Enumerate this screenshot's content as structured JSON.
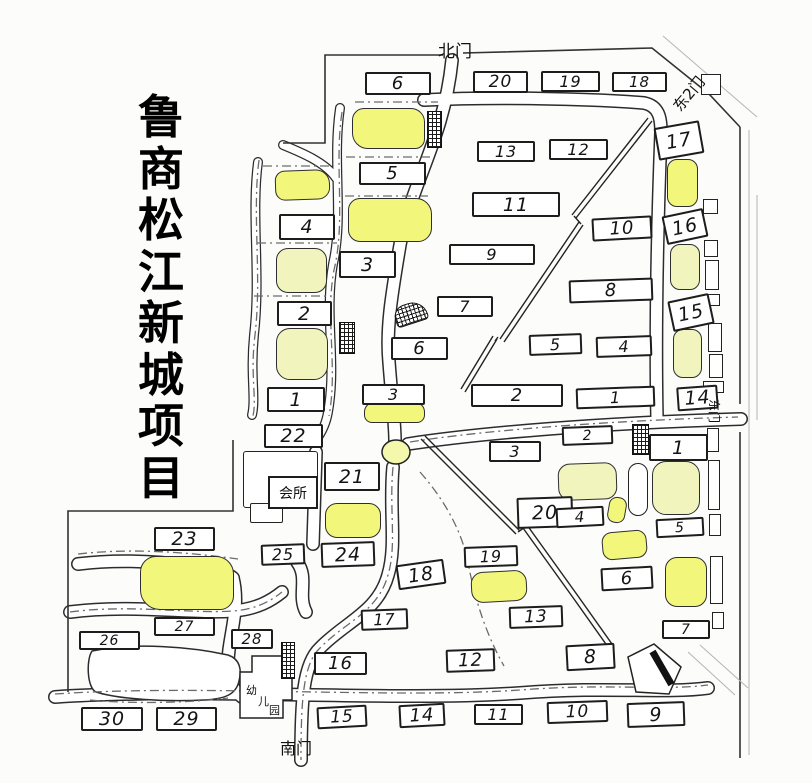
{
  "title": {
    "text": "鲁商松江新城项目",
    "vertical_text": "鲁\n商\n松\n江\n新\n城\n项\n目"
  },
  "colors": {
    "ink": "#222222",
    "highlight_yellow": "#f2f77b",
    "pale_yellow": "#f1f5bd",
    "paper": "#fcfcfa"
  },
  "gates": [
    {
      "id": "north-gate-label",
      "label": "北门",
      "x": 438,
      "y": 37,
      "rot": 0,
      "size": 17
    },
    {
      "id": "northeast-gate-label",
      "label": "东2门",
      "x": 668,
      "y": 102,
      "rot": -50,
      "size": 15
    },
    {
      "id": "east-gate-label",
      "label": "东门",
      "x": 723,
      "y": 399,
      "rot": 90,
      "size": 12
    },
    {
      "id": "south-gate-label",
      "label": "南门",
      "x": 280,
      "y": 735,
      "rot": 0,
      "size": 16
    }
  ],
  "special_buildings": {
    "clubhouse": {
      "label": "会所"
    },
    "kindergarten": {
      "label": "幼儿园",
      "chars": [
        "幼",
        "儿",
        "园"
      ]
    }
  },
  "roundabout": {
    "cx": 396,
    "cy": 452,
    "rx": 14,
    "ry": 12
  },
  "numbered_boxes": [
    {
      "label": "6",
      "x": 365,
      "y": 72,
      "w": 66,
      "h": 23,
      "rot": 0
    },
    {
      "label": "5",
      "x": 359,
      "y": 162,
      "w": 67,
      "h": 23,
      "rot": 0
    },
    {
      "label": "4",
      "x": 279,
      "y": 214,
      "w": 56,
      "h": 26,
      "rot": 0
    },
    {
      "label": "3",
      "x": 339,
      "y": 251,
      "w": 57,
      "h": 27,
      "rot": 0
    },
    {
      "label": "2",
      "x": 277,
      "y": 301,
      "w": 55,
      "h": 25,
      "rot": 0
    },
    {
      "label": "1",
      "x": 267,
      "y": 387,
      "w": 58,
      "h": 25,
      "rot": 0
    },
    {
      "label": "20",
      "x": 473,
      "y": 71,
      "w": 55,
      "h": 22,
      "rot": 0
    },
    {
      "label": "19",
      "x": 541,
      "y": 71,
      "w": 59,
      "h": 21,
      "rot": 0
    },
    {
      "label": "18",
      "x": 612,
      "y": 72,
      "w": 55,
      "h": 20,
      "rot": 0
    },
    {
      "label": "13",
      "x": 477,
      "y": 141,
      "w": 58,
      "h": 21,
      "rot": 0
    },
    {
      "label": "12",
      "x": 549,
      "y": 139,
      "w": 59,
      "h": 21,
      "rot": 0
    },
    {
      "label": "11",
      "x": 472,
      "y": 192,
      "w": 88,
      "h": 25,
      "rot": 0
    },
    {
      "label": "10",
      "x": 592,
      "y": 217,
      "w": 60,
      "h": 23,
      "rot": -3
    },
    {
      "label": "9",
      "x": 449,
      "y": 244,
      "w": 86,
      "h": 21,
      "rot": 0
    },
    {
      "label": "8",
      "x": 569,
      "y": 279,
      "w": 84,
      "h": 23,
      "rot": -2
    },
    {
      "label": "7",
      "x": 437,
      "y": 296,
      "w": 56,
      "h": 21,
      "rot": 0
    },
    {
      "label": "6",
      "x": 391,
      "y": 337,
      "w": 57,
      "h": 23,
      "rot": 0
    },
    {
      "label": "5",
      "x": 529,
      "y": 334,
      "w": 53,
      "h": 21,
      "rot": -2
    },
    {
      "label": "4",
      "x": 596,
      "y": 336,
      "w": 56,
      "h": 21,
      "rot": -2
    },
    {
      "label": "3",
      "x": 362,
      "y": 384,
      "w": 63,
      "h": 21,
      "rot": 0
    },
    {
      "label": "2",
      "x": 471,
      "y": 384,
      "w": 92,
      "h": 23,
      "rot": 0
    },
    {
      "label": "1",
      "x": 576,
      "y": 387,
      "w": 79,
      "h": 21,
      "rot": -2
    },
    {
      "label": "17",
      "x": 656,
      "y": 124,
      "w": 46,
      "h": 33,
      "rot": -10
    },
    {
      "label": "16",
      "x": 664,
      "y": 212,
      "w": 42,
      "h": 29,
      "rot": -12
    },
    {
      "label": "15",
      "x": 670,
      "y": 297,
      "w": 42,
      "h": 31,
      "rot": -12
    },
    {
      "label": "14",
      "x": 677,
      "y": 386,
      "w": 41,
      "h": 24,
      "rot": -4
    },
    {
      "label": "22",
      "x": 264,
      "y": 424,
      "w": 59,
      "h": 24,
      "rot": 0
    },
    {
      "label": "21",
      "x": 324,
      "y": 462,
      "w": 56,
      "h": 29,
      "rot": 0
    },
    {
      "label": "2",
      "x": 562,
      "y": 426,
      "w": 51,
      "h": 19,
      "rot": -2
    },
    {
      "label": "1",
      "x": 649,
      "y": 434,
      "w": 59,
      "h": 27,
      "rot": 0
    },
    {
      "label": "3",
      "x": 489,
      "y": 441,
      "w": 52,
      "h": 21,
      "rot": 0
    },
    {
      "label": "20",
      "x": 517,
      "y": 497,
      "w": 56,
      "h": 31,
      "rot": -2
    },
    {
      "label": "4",
      "x": 556,
      "y": 507,
      "w": 48,
      "h": 20,
      "rot": -3
    },
    {
      "label": "5",
      "x": 656,
      "y": 518,
      "w": 48,
      "h": 19,
      "rot": -3
    },
    {
      "label": "6",
      "x": 601,
      "y": 567,
      "w": 52,
      "h": 23,
      "rot": -3
    },
    {
      "label": "7",
      "x": 662,
      "y": 620,
      "w": 48,
      "h": 19,
      "rot": 0
    },
    {
      "label": "19",
      "x": 464,
      "y": 546,
      "w": 54,
      "h": 21,
      "rot": -2
    },
    {
      "label": "18",
      "x": 397,
      "y": 562,
      "w": 48,
      "h": 25,
      "rot": -8
    },
    {
      "label": "13",
      "x": 509,
      "y": 606,
      "w": 54,
      "h": 22,
      "rot": -2
    },
    {
      "label": "17",
      "x": 361,
      "y": 609,
      "w": 47,
      "h": 21,
      "rot": -2
    },
    {
      "label": "16",
      "x": 314,
      "y": 652,
      "w": 53,
      "h": 23,
      "rot": 0
    },
    {
      "label": "12",
      "x": 446,
      "y": 649,
      "w": 49,
      "h": 23,
      "rot": -2
    },
    {
      "label": "8",
      "x": 566,
      "y": 644,
      "w": 49,
      "h": 26,
      "rot": -3
    },
    {
      "label": "15",
      "x": 317,
      "y": 706,
      "w": 50,
      "h": 22,
      "rot": -3
    },
    {
      "label": "14",
      "x": 399,
      "y": 704,
      "w": 46,
      "h": 23,
      "rot": -3
    },
    {
      "label": "11",
      "x": 474,
      "y": 704,
      "w": 49,
      "h": 21,
      "rot": 0
    },
    {
      "label": "10",
      "x": 547,
      "y": 701,
      "w": 61,
      "h": 22,
      "rot": -2
    },
    {
      "label": "9",
      "x": 627,
      "y": 702,
      "w": 58,
      "h": 25,
      "rot": -2
    },
    {
      "label": "23",
      "x": 154,
      "y": 527,
      "w": 61,
      "h": 24,
      "rot": 0
    },
    {
      "label": "25",
      "x": 261,
      "y": 544,
      "w": 44,
      "h": 21,
      "rot": -2
    },
    {
      "label": "24",
      "x": 321,
      "y": 542,
      "w": 54,
      "h": 25,
      "rot": -2
    },
    {
      "label": "26",
      "x": 79,
      "y": 631,
      "w": 61,
      "h": 19,
      "rot": 0
    },
    {
      "label": "27",
      "x": 154,
      "y": 617,
      "w": 61,
      "h": 19,
      "rot": 0
    },
    {
      "label": "28",
      "x": 231,
      "y": 629,
      "w": 42,
      "h": 20,
      "rot": 0
    },
    {
      "label": "30",
      "x": 81,
      "y": 707,
      "w": 62,
      "h": 24,
      "rot": 0
    },
    {
      "label": "29",
      "x": 156,
      "y": 707,
      "w": 61,
      "h": 24,
      "rot": 0
    }
  ],
  "yellow_buildings": [
    {
      "x": 352,
      "y": 108,
      "w": 73,
      "h": 41,
      "shade": "bright",
      "r": "12px 14px 10px 16px",
      "rot": 0
    },
    {
      "x": 275,
      "y": 170,
      "w": 55,
      "h": 30,
      "shade": "bright",
      "r": "10px 14px 12px 10px",
      "rot": -2
    },
    {
      "x": 348,
      "y": 198,
      "w": 84,
      "h": 44,
      "shade": "bright",
      "r": "12px 16px 14px 12px",
      "rot": 0
    },
    {
      "x": 276,
      "y": 248,
      "w": 51,
      "h": 45,
      "shade": "pale",
      "r": "12px",
      "rot": 0
    },
    {
      "x": 276,
      "y": 328,
      "w": 52,
      "h": 52,
      "shade": "pale",
      "r": "14px",
      "rot": 0
    },
    {
      "x": 667,
      "y": 159,
      "w": 31,
      "h": 48,
      "shade": "bright",
      "r": "10px",
      "rot": 0
    },
    {
      "x": 670,
      "y": 244,
      "w": 30,
      "h": 46,
      "shade": "pale",
      "r": "10px",
      "rot": 0
    },
    {
      "x": 673,
      "y": 329,
      "w": 29,
      "h": 49,
      "shade": "pale",
      "r": "10px",
      "rot": 0
    },
    {
      "x": 325,
      "y": 503,
      "w": 56,
      "h": 35,
      "shade": "bright",
      "r": "12px",
      "rot": 0
    },
    {
      "x": 558,
      "y": 463,
      "w": 59,
      "h": 37,
      "shade": "pale",
      "r": "12px",
      "rot": -2
    },
    {
      "x": 652,
      "y": 461,
      "w": 48,
      "h": 54,
      "shade": "pale",
      "r": "14px",
      "rot": 0
    },
    {
      "x": 608,
      "y": 497,
      "w": 18,
      "h": 26,
      "shade": "bright",
      "r": "8px",
      "rot": 10
    },
    {
      "x": 602,
      "y": 531,
      "w": 45,
      "h": 28,
      "shade": "bright",
      "r": "10px",
      "rot": -5
    },
    {
      "x": 665,
      "y": 557,
      "w": 42,
      "h": 50,
      "shade": "bright",
      "r": "12px",
      "rot": 0
    },
    {
      "x": 471,
      "y": 571,
      "w": 56,
      "h": 31,
      "shade": "bright",
      "r": "12px",
      "rot": -3
    },
    {
      "x": 140,
      "y": 556,
      "w": 94,
      "h": 54,
      "shade": "bright",
      "r": "16px 18px 14px 20px",
      "rot": 0
    },
    {
      "x": 364,
      "y": 402,
      "w": 61,
      "h": 21,
      "shade": "bright",
      "r": "10px 10px 8px 8px",
      "rot": 0
    }
  ],
  "white_buildings": [
    {
      "x": 628,
      "y": 463,
      "w": 20,
      "h": 53,
      "r": "10px",
      "rot": 0
    },
    {
      "x": 243,
      "y": 451,
      "w": 75,
      "h": 57,
      "r": "3px",
      "rot": 0
    },
    {
      "x": 250,
      "y": 503,
      "w": 33,
      "h": 20,
      "r": "2px",
      "rot": 0
    }
  ],
  "small_units": [
    {
      "x": 701,
      "y": 74,
      "w": 20,
      "h": 21
    },
    {
      "x": 703,
      "y": 199,
      "w": 15,
      "h": 15
    },
    {
      "x": 704,
      "y": 240,
      "w": 14,
      "h": 17
    },
    {
      "x": 705,
      "y": 260,
      "w": 14,
      "h": 30
    },
    {
      "x": 706,
      "y": 294,
      "w": 14,
      "h": 12
    },
    {
      "x": 708,
      "y": 323,
      "w": 14,
      "h": 29
    },
    {
      "x": 709,
      "y": 354,
      "w": 14,
      "h": 24
    },
    {
      "x": 703,
      "y": 381,
      "w": 21,
      "h": 12
    },
    {
      "x": 707,
      "y": 428,
      "w": 12,
      "h": 24
    },
    {
      "x": 708,
      "y": 460,
      "w": 12,
      "h": 50
    },
    {
      "x": 709,
      "y": 514,
      "w": 12,
      "h": 22
    },
    {
      "x": 710,
      "y": 556,
      "w": 13,
      "h": 48
    },
    {
      "x": 712,
      "y": 612,
      "w": 12,
      "h": 17
    }
  ],
  "hatched_structures": [
    {
      "x": 427,
      "y": 111,
      "w": 15,
      "h": 37,
      "rot": 0,
      "r": "0"
    },
    {
      "x": 339,
      "y": 322,
      "w": 16,
      "h": 32,
      "rot": 0,
      "r": "0"
    },
    {
      "x": 394,
      "y": 303,
      "w": 33,
      "h": 21,
      "rot": -18,
      "r": "12px 16px 4px 4px"
    },
    {
      "x": 632,
      "y": 424,
      "w": 17,
      "h": 31,
      "rot": 0,
      "r": "0"
    },
    {
      "x": 281,
      "y": 642,
      "w": 14,
      "h": 37,
      "rot": 0,
      "r": "0"
    }
  ]
}
